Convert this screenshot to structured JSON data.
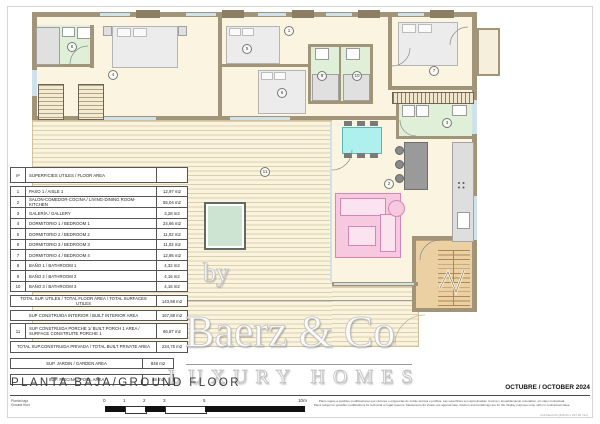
{
  "sheet": {
    "title": "PLANTA BAJA/GROUND FLOOR",
    "subtitle_line1": "Planta baja",
    "subtitle_line2": "Ground floor",
    "date": "OCTUBRE / OCTOBER 2024",
    "disclaimer_line1": "Plano sujeto a posibles modificaciones por razones o exigencias de índole técnica o jurídica. Las superficies son aproximadas. Cocina y amueblamiento orientativo, sin valor contractual.",
    "disclaimer_line2": "Plans subject to possible modifications for technical or legal reasons. Measurements shown are approximate. Kitchen and furnishings are for the display purposes only, with no contractual value.",
    "corner_note": "Full bleed A3 (420.00 x 297.00 mm)"
  },
  "watermark": {
    "by": "by",
    "brand": "Baerz & Co",
    "tagline": "LUXURY HOMES"
  },
  "area_table": {
    "header": {
      "num": "nº",
      "label": "SUPERFICIES UTILES / FLOOR AREA"
    },
    "rows": [
      {
        "num": "1",
        "label": "PASO 1 / AISLE 1",
        "value": "12,97 m2"
      },
      {
        "num": "2",
        "label": "SALON-COMEDOR-COCINA /  LIVING-DINING ROOM-KITCHEN",
        "value": "55,04 m2"
      },
      {
        "num": "3",
        "label": "GALERÍA / GALLERY",
        "value": "3,28 m2"
      },
      {
        "num": "4",
        "label": "DORMITORIO 1 / BEDROOM 1",
        "value": "24,66 m2"
      },
      {
        "num": "5",
        "label": "DORMITORIO 2 / BEDROOM 2",
        "value": "11,02 m2"
      },
      {
        "num": "6",
        "label": "DORMITORIO 3 / BEDROOM 3",
        "value": "11,02 m2"
      },
      {
        "num": "7",
        "label": "DORMITORIO 4 / BEDROOM 4",
        "value": "12,95 m2"
      },
      {
        "num": "8",
        "label": "BAÑO 1 / BATHROOM 1",
        "value": "4,32 m2"
      },
      {
        "num": "9",
        "label": "BAÑO 2 / BATHROOM 2",
        "value": "4,16 m2"
      },
      {
        "num": "10",
        "label": "BAÑO 3 / BATHROOM 3",
        "value": "4,16 m2"
      }
    ],
    "total_utiles": {
      "label": "TOTAL SUP. UTILES / TOTAL FLOOR AREA / TOTAL SURFACES UTILES",
      "value": "143,58 m2"
    },
    "built_interior": {
      "label": "SUP CONSTRUIDA INTERIOR / BUILT INTERIOR AREA",
      "value": "167,88 m2"
    },
    "porch": {
      "num": "11",
      "label": "SUP CONSTRUIDA PORCHE 1/ BUILT PORCH 1 AREA / SURFACE CONSTRUITE PORCHE 1",
      "value": "66,87 m2"
    },
    "total_private": {
      "label": "TOTAL SUP.CONSTRUIDA PRIVADA / TOTAL  BUILT PRIVATE AREA",
      "value": "234,75 m2"
    },
    "garden": {
      "label": "SUP. JARDIN / GARDEN AREA",
      "value": "848 m2"
    },
    "pool": {
      "label": "SUP. PISCINA / POOL AREA",
      "value": "48 m2"
    }
  },
  "scale_bar": {
    "ticks": [
      "0",
      "1",
      "2",
      "3",
      "5",
      "10m"
    ]
  },
  "plan": {
    "room_labels": [
      "1",
      "2",
      "3",
      "4",
      "5",
      "6",
      "7",
      "8",
      "9",
      "10",
      "11"
    ]
  },
  "colors": {
    "wall": "#a29478",
    "floor": "#fbf4e1",
    "bathroom": "#e0f0d8",
    "deck_line": "#d8c9a6",
    "stairs": "#ead0a2",
    "pool_water": "#cde4d2",
    "sofa": "#f7c9e0",
    "dining_table": "#aef0ee",
    "window": "#cfe2ec"
  }
}
